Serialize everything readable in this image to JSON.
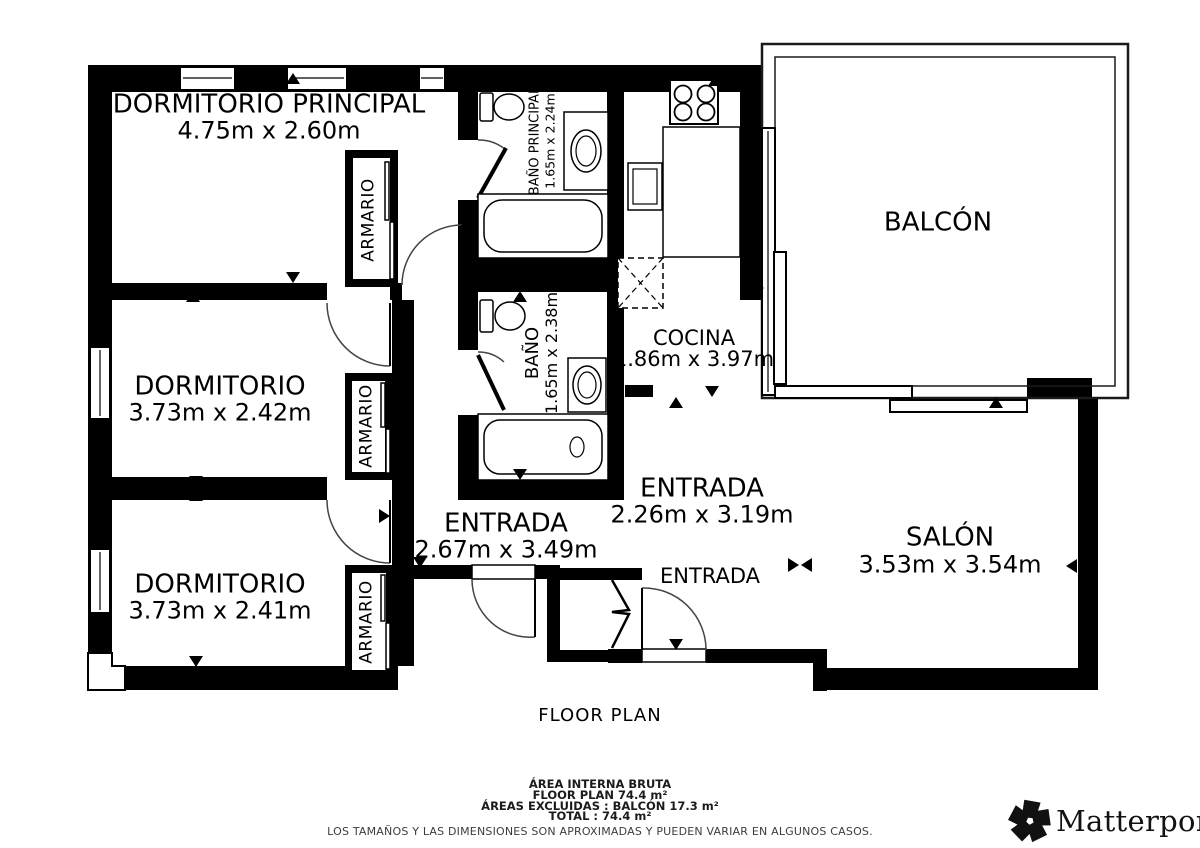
{
  "plan": {
    "rooms": {
      "dormitorio_principal": {
        "name": "DORMITORIO PRINCIPAL",
        "dims": "4.75m x 2.60m"
      },
      "dormitorio_2": {
        "name": "DORMITORIO",
        "dims": "3.73m x 2.42m"
      },
      "dormitorio_3": {
        "name": "DORMITORIO",
        "dims": "3.73m x 2.41m"
      },
      "armario": {
        "name": "ARMARIO"
      },
      "bano_principal": {
        "name": "BAÑO PRINCIPAL",
        "dims": "1.65m x 2.24m"
      },
      "bano": {
        "name": "BAÑO",
        "dims": "1.65m x 2.38m"
      },
      "cocina": {
        "name": "COCINA",
        "dims": "1.86m x 3.97m"
      },
      "entrada_hall": {
        "name": "ENTRADA",
        "dims": "2.67m x 3.49m"
      },
      "entrada_centro": {
        "name": "ENTRADA",
        "dims": "2.26m x 3.19m"
      },
      "entrada_puerta": {
        "name": "ENTRADA"
      },
      "salon": {
        "name": "SALÓN",
        "dims": "3.53m x 3.54m"
      },
      "balcon": {
        "name": "BALCÓN"
      }
    },
    "title": "FLOOR PLAN",
    "summary": {
      "area_interna_bruta": "ÁREA INTERNA BRUTA",
      "floor_plan_total": "FLOOR PLAN 74.4 m²",
      "areas_excluidas": "ÁREAS EXCLUIDAS :  BALCÓN 17.3 m²",
      "total": "TOTAL :  74.4 m²",
      "disclaimer": "LOS TAMAÑOS Y LAS DIMENSIONES SON APROXIMADAS Y PUEDEN VARIAR EN ALGUNOS CASOS."
    },
    "brand": {
      "name": "Matterport",
      "registered": "®"
    },
    "colors": {
      "wall": "#000000",
      "background": "#ffffff"
    }
  }
}
